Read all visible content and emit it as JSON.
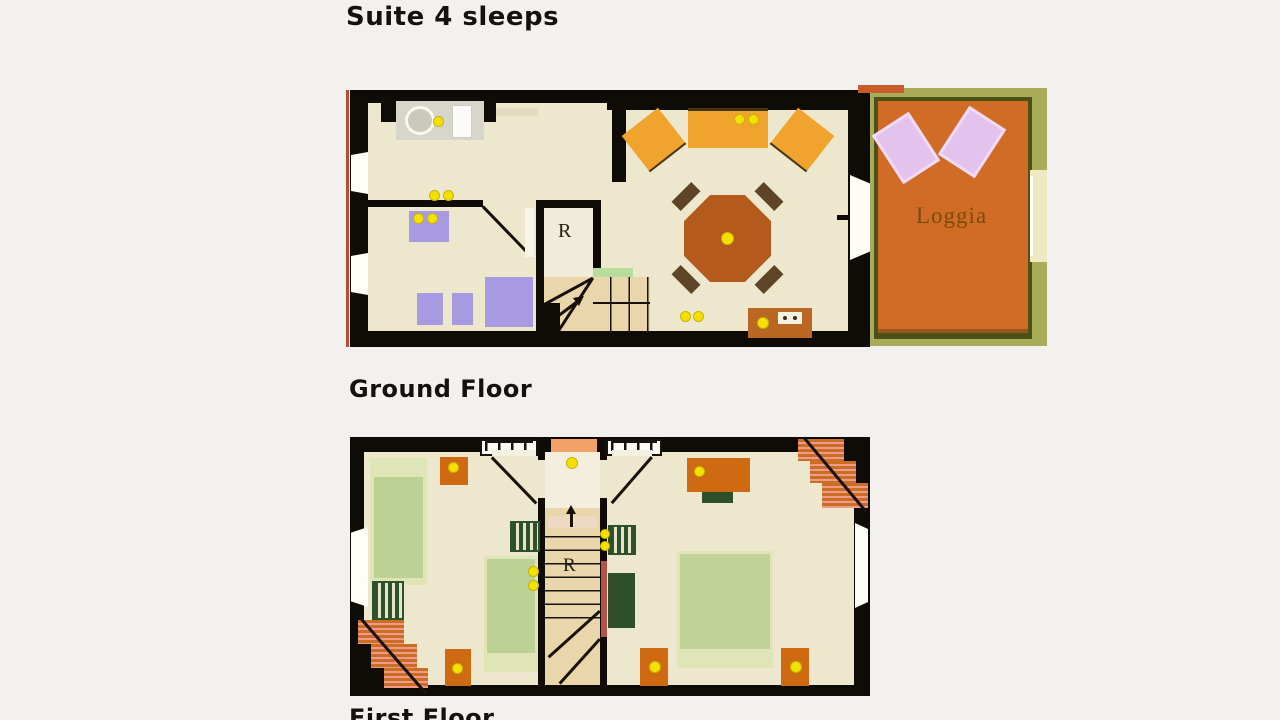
{
  "title": "Suite 4 sleeps",
  "floors": {
    "ground": {
      "label": "Ground Floor",
      "room_label": "R",
      "loggia_label": "Loggia"
    },
    "first": {
      "label": "First Floor",
      "room_label": "R"
    }
  },
  "palette": {
    "page_background": "#f2f1ed",
    "wall_black": "#0f0c08",
    "floor_cream": "#ece7cd",
    "kitchen_gray": "#d8d5ca",
    "bath_purple": "#a79ae0",
    "seating_orange": "#f1a42d",
    "table_brown": "#b45a1d",
    "sideboard_brown": "#b96722",
    "nightstand_orange": "#cf6a12",
    "loggia_terracotta": "#d16c26",
    "loggia_olive": "#a9ac58",
    "loggia_dark_olive": "#4d5115",
    "lounger_lavender": "#e3c3ee",
    "bed_green": "#bdd194",
    "bed_trim_green": "#dfe5b6",
    "dark_green": "#2f5129",
    "stair_tan": "#e9d6ab",
    "stair_stripe_pink": "#f09a8e",
    "stair_stripe_orange": "#c96e22",
    "lamp_dot_yellow": "#f3e104",
    "label_text": "#15120e",
    "loggia_text": "#7c4a0c"
  }
}
